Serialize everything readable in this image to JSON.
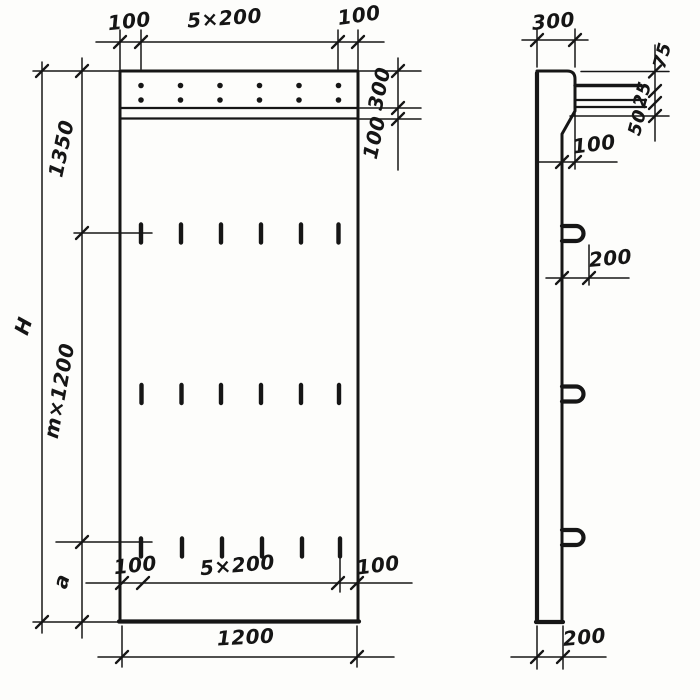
{
  "drawing": {
    "kind": "panel-working-drawing",
    "front": {
      "top_dim": {
        "left": "100",
        "center": "5×200",
        "right": "100"
      },
      "right_dim": {
        "band": "300",
        "strip": "100"
      },
      "left_dim": {
        "overall": "H",
        "upper": "1350",
        "module": "m×1200",
        "lower": "a"
      },
      "bottom_dim": {
        "left": "100",
        "center": "5×200",
        "right": "100"
      },
      "width_dim": "1200"
    },
    "side": {
      "width_dim": "300",
      "right_chain": {
        "top": "75",
        "mid": "25",
        "bottom": "50"
      },
      "step_dim": "100",
      "loop_dim": "200",
      "thickness_dim": "200"
    },
    "ink_color": "#161616",
    "paper_color": "#fdfdfb"
  }
}
